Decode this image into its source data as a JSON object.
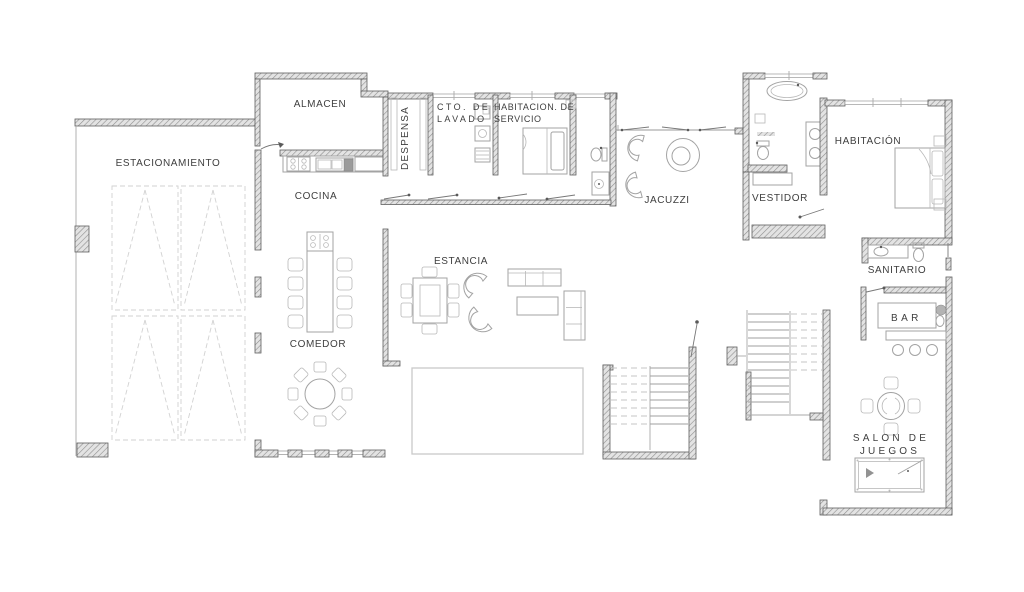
{
  "plan": {
    "title": "floor-plan",
    "labels": {
      "estacionamiento": "ESTACIONAMIENTO",
      "almacen": "ALMACEN",
      "despensa": "DESPENSA",
      "lavado_line1": "CTO. DE",
      "lavado_line2": "LAVADO",
      "servicio_line1": "HABITACION.  DE",
      "servicio_line2": "SERVICIO",
      "jacuzzi": "JACUZZI",
      "habitacion": "HABITACIÓN",
      "vestidor": "VESTIDOR",
      "sanitario": "SANITARIO",
      "cocina": "COCINA",
      "comedor": "COMEDOR",
      "estancia": "ESTANCIA",
      "bar": "B A R",
      "salon_line1": "SALON  DE",
      "salon_line2": "JUEGOS"
    },
    "colors": {
      "background": "#ffffff",
      "wall_fill": "#e3e3e3",
      "wall_hatch": "#8f8f8f",
      "wall_edge": "#5f5f5f",
      "furniture": "#a3a3a3",
      "parking_marks": "#d2d2d2",
      "text": "#3e3e3e"
    }
  }
}
